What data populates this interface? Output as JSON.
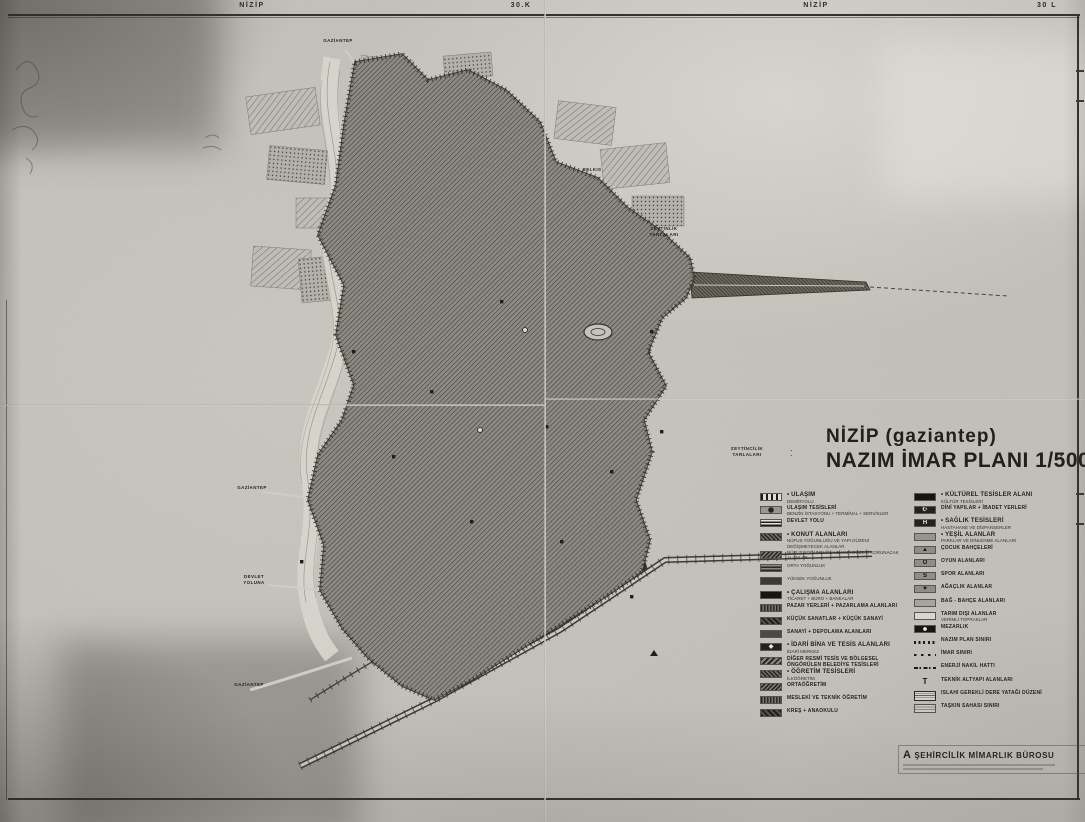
{
  "colors": {
    "paper": "#c7c5be",
    "ink": "#24231d"
  },
  "header": {
    "left_name": "NİZİP",
    "left_grid": "30.K",
    "right_name": "NİZİP",
    "right_grid": "30 L"
  },
  "title_block": {
    "line1": "NİZİP (gaziantep)",
    "line2": "NAZIM İMAR PLANI 1/5000"
  },
  "legend": {
    "left": [
      {
        "bullet": true,
        "label": "ULAŞIM",
        "sub": "DEMİRYOLU",
        "swatch": "railway"
      },
      {
        "main": "ULAŞIM TESİSLERİ",
        "sub": "BENZİN İSTASYONU + TERMİNAL + SERVİSLER",
        "swatch": "station"
      },
      {
        "main": "DEVLET YOLU",
        "swatch": "road"
      },
      {
        "bullet": true,
        "label": "KONUT ALANLARI",
        "sub": "NÜFUS YOĞUNLUĞU VE YAPI DÜZENİ DEĞİŞMEYECEK ALANLAR",
        "swatch": "d1"
      },
      {
        "sub": "NÜFUS YOĞUNLUĞU VE YAPI DÜZENİ KORUNACAK ALANLAR",
        "swatch": "d2"
      },
      {
        "sub": "ORTA YOĞUNLUK",
        "swatch": "d3"
      },
      {
        "sub": "YÜKSEK YOĞUNLUK",
        "swatch": "d4"
      },
      {
        "bullet": true,
        "label": "ÇALIŞMA ALANLARI",
        "sub": "TİCARET + BÜRO + BANKALAR",
        "swatch": "black"
      },
      {
        "main": "PAZAR YERLERİ + PAZARLAMA ALANLARI",
        "swatch": "d5"
      },
      {
        "main": "KÜÇÜK SANATLAR + KÜÇÜK SANAYİ",
        "swatch": "d6"
      },
      {
        "main": "SANAYİ + DEPOLAMA ALANLARI",
        "swatch": "d7"
      },
      {
        "bullet": true,
        "label": "İDARİ BİNA VE TESİS ALANLARI",
        "sub": "İDARİ MERKEZ",
        "swatch": "glyph",
        "glyph": "◆"
      },
      {
        "main": "DİĞER RESMİ TESİS VE BÖLGESEL ÖNGÖRÜLEN BELEDİYE TESİSLERİ",
        "swatch": "d8"
      },
      {
        "bullet": true,
        "label": "ÖĞRETİM TESİSLERİ",
        "sub": "İLKÖĞRETİM",
        "swatch": "d1"
      },
      {
        "main": "ORTAÖĞRETİM",
        "swatch": "d2"
      },
      {
        "main": "MESLEKİ VE TEKNİK ÖĞRETİM",
        "swatch": "d5"
      },
      {
        "main": "KREŞ + ANAOKULU",
        "swatch": "d6"
      }
    ],
    "right": [
      {
        "bullet": true,
        "label": "KÜLTÜREL TESİSLER ALANI",
        "sub": "KÜLTÜR TESİSLERİ",
        "swatch": "black"
      },
      {
        "main": "DİNİ YAPILAR + İBADET YERLERİ",
        "swatch": "glyph",
        "glyph": "☪"
      },
      {
        "bullet": true,
        "label": "SAĞLIK TESİSLERİ",
        "sub": "HASTAHANE VE DİSPANSERLER",
        "swatch": "glyph",
        "glyph": "H"
      },
      {
        "bullet": true,
        "label": "YEŞİL ALANLAR",
        "sub": "PARKLAR VE DİNLENME ALANLARI",
        "swatch": "gray"
      },
      {
        "main": "ÇOCUK BAHÇELERİ",
        "swatch": "glyph-gray",
        "glyph": "▲"
      },
      {
        "main": "OYUN ALANLARI",
        "swatch": "glyph-gray",
        "glyph": "O"
      },
      {
        "main": "SPOR ALANLARI",
        "swatch": "glyph-gray",
        "glyph": "S"
      },
      {
        "main": "AĞAÇLIK ALANLAR",
        "swatch": "glyph-gray",
        "glyph": "✦"
      },
      {
        "main": "BAĞ - BAHÇE ALANLARI",
        "swatch": "gray2"
      },
      {
        "main": "TARIM DIŞI ALANLAR",
        "sub": "VERİMLİ TOPRAKLAR",
        "swatch": "outline"
      },
      {
        "main": "MEZARLIK",
        "swatch": "dot"
      },
      {
        "main": "NAZIM PLAN SINIRI",
        "swatch": "lineDots"
      },
      {
        "main": "İMAR SINIRI",
        "swatch": "lineDash"
      },
      {
        "main": "ENERJİ NAKİL HATTI",
        "swatch": "lineDashDot"
      },
      {
        "main": "TEKNİK ALTYAPI ALANLARI",
        "swatch": "T",
        "glyph": "T"
      },
      {
        "main": "ISLAHI GEREKLİ DERE YATAĞI DÜZENİ",
        "swatch": "hatchbox"
      },
      {
        "main": "TAŞKIN SAHASI SINIRI",
        "swatch": "stripebox"
      }
    ]
  },
  "map_labels": [
    {
      "main": "GAZİANTEP",
      "x": 338,
      "y": 38
    },
    {
      "main": "BELKIS",
      "x": 592,
      "y": 167
    },
    {
      "main": "ZEYTİNLİK\nTARLALARI",
      "x": 664,
      "y": 226
    },
    {
      "main": "ZEYTİNCİLİK\nTARLALARI",
      "x": 747,
      "y": 446
    },
    {
      "main": "GAZİANTEP",
      "x": 252,
      "y": 485
    },
    {
      "main": "DEVLET\nYOLUNA",
      "x": 254,
      "y": 574
    },
    {
      "main": "GAZİANTEP",
      "x": 249,
      "y": 682
    }
  ],
  "attribution": {
    "firm": "A ŞEHİRCİLİK MİMARLIK BÜROSU"
  }
}
